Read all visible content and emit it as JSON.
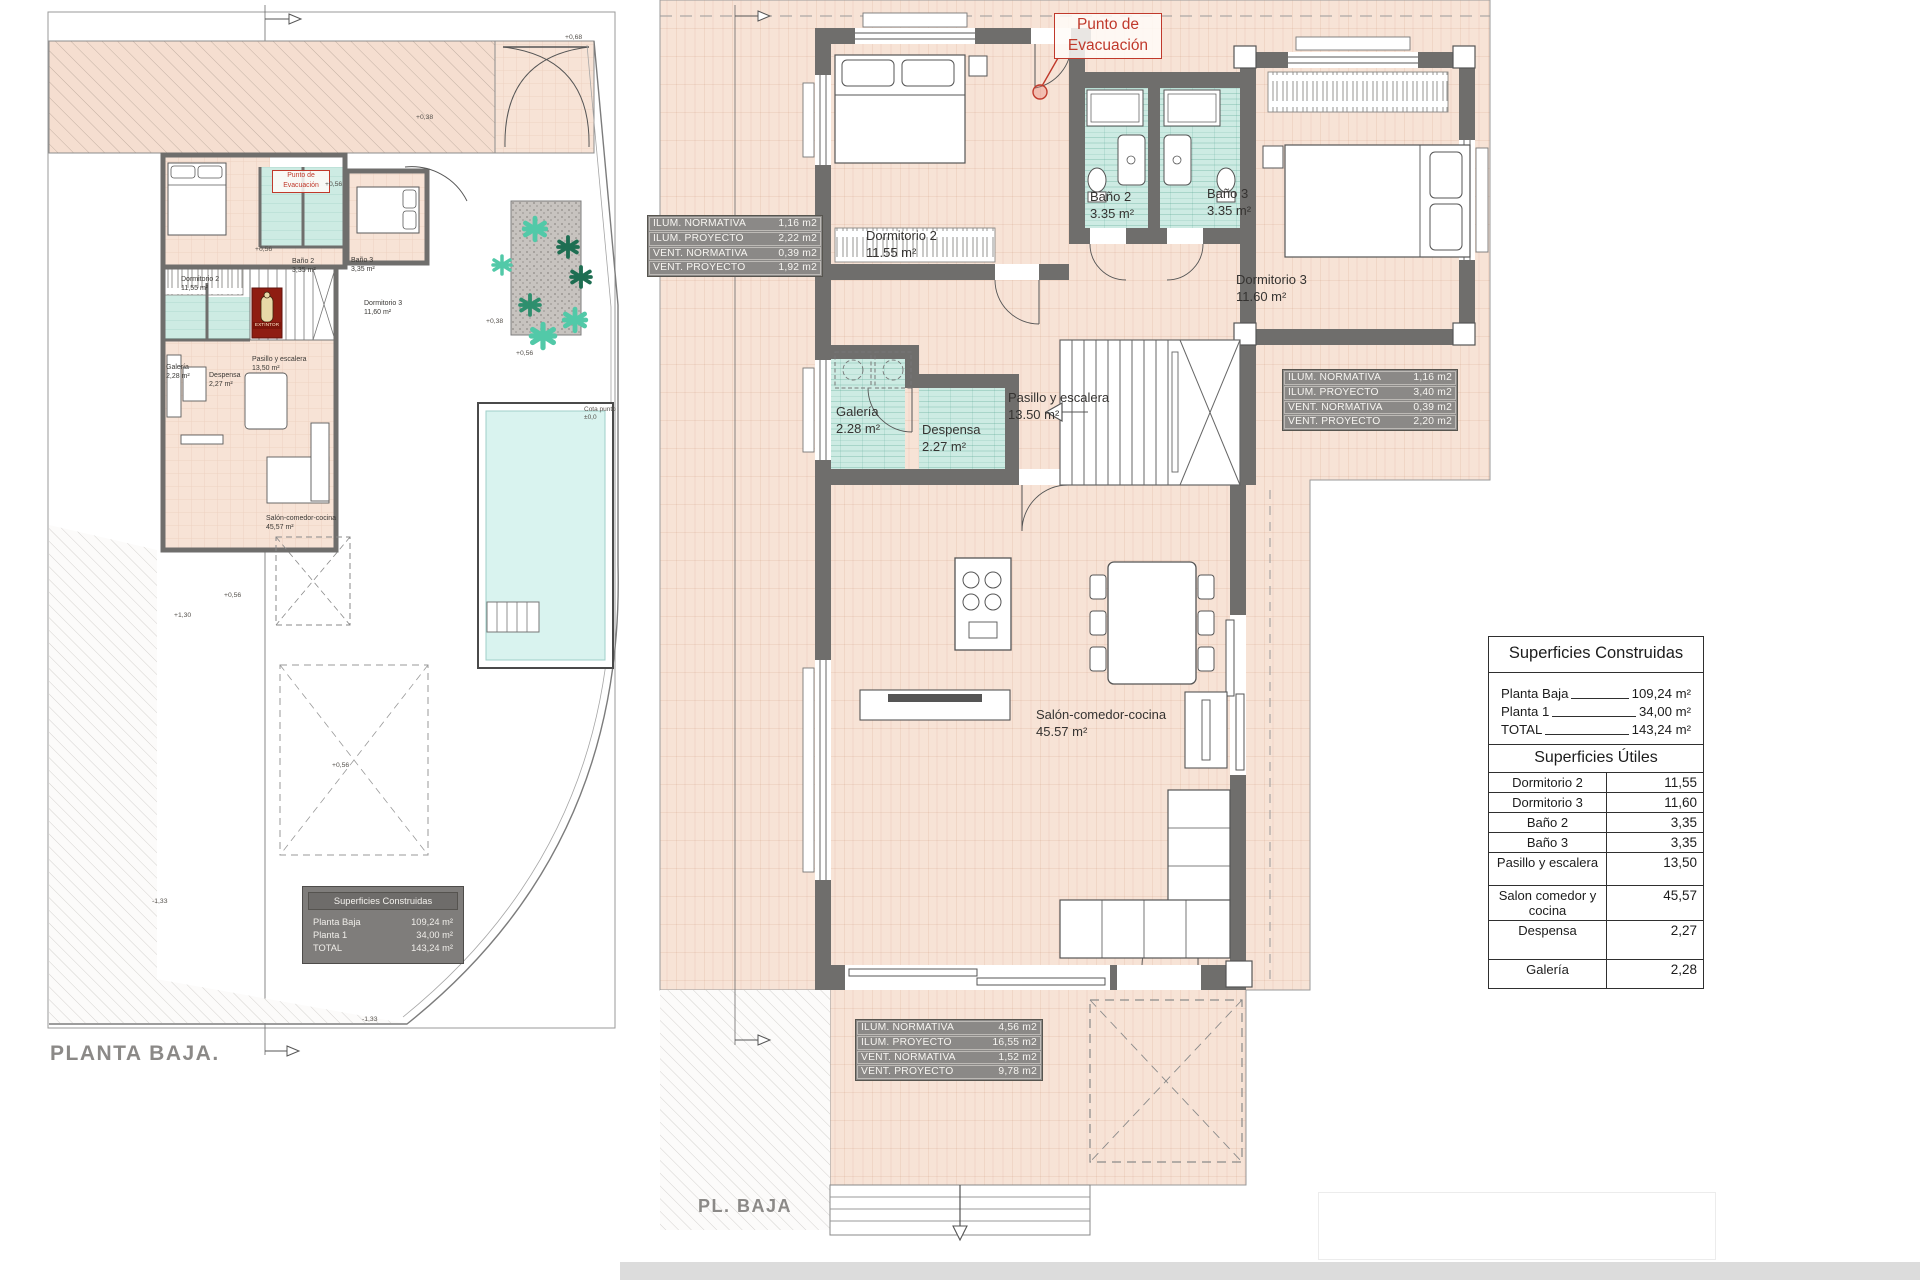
{
  "left_plan": {
    "title": "PLANTA BAJA.",
    "evacuation": {
      "line1": "Punto de",
      "line2": "Evacuación"
    },
    "extintor_label": "EXTINTOR",
    "cota_label": {
      "line1": "Cota punto",
      "line2": "±0,0"
    },
    "rooms": {
      "dormitorio2": {
        "name": "Dormitorio 2",
        "area": "11,55 m²"
      },
      "bano2": {
        "name": "Baño 2",
        "area": "3,35 m²"
      },
      "bano3": {
        "name": "Baño 3",
        "area": "3,35 m²"
      },
      "dormitorio3": {
        "name": "Dormitorio 3",
        "area": "11,60 m²"
      },
      "galeria": {
        "name": "Galería",
        "area": "2,28 m²"
      },
      "despensa": {
        "name": "Despensa",
        "area": "2,27 m²"
      },
      "pasillo": {
        "name": "Pasillo y escalera",
        "area": "13,50 m²"
      },
      "salon": {
        "name": "Salón-comedor-cocina",
        "area": "45,57 m²"
      }
    },
    "elevations": {
      "e068": "+0,68",
      "e038_a": "+0,38",
      "e038_b": "+0,38",
      "e056_a": "+0,56",
      "e056_b": "+0,56",
      "e056_c": "+0,56",
      "e056_d": "+0,56",
      "e056_e": "+0,56",
      "e130": "+1,30",
      "em133_a": "-1,33",
      "em133_b": "-1,33"
    }
  },
  "right_plan": {
    "title": "PL. BAJA",
    "evacuation": {
      "line1": "Punto de",
      "line2": "Evacuación"
    },
    "rooms": {
      "dormitorio2": {
        "name": "Dormitorio 2",
        "area": "11.55 m²"
      },
      "bano2": {
        "name": "Baño 2",
        "area": "3.35 m²"
      },
      "bano3": {
        "name": "Baño 3",
        "area": "3.35 m²"
      },
      "dormitorio3": {
        "name": "Dormitorio 3",
        "area": "11.60 m²"
      },
      "galeria": {
        "name": "Galería",
        "area": "2.28 m²"
      },
      "despensa": {
        "name": "Despensa",
        "area": "2.27 m²"
      },
      "pasillo": {
        "name": "Pasillo y escalera",
        "area": "13.50 m²"
      },
      "salon": {
        "name": "Salón-comedor-cocina",
        "area": "45.57 m²"
      }
    },
    "vent_tables": {
      "dormitorio2": [
        [
          "ILUM. NORMATIVA",
          "1,16 m2"
        ],
        [
          "ILUM. PROYECTO",
          "2,22 m2"
        ],
        [
          "VENT. NORMATIVA",
          "0,39 m2"
        ],
        [
          "VENT. PROYECTO",
          "1,92 m2"
        ]
      ],
      "dormitorio3": [
        [
          "ILUM. NORMATIVA",
          "1,16 m2"
        ],
        [
          "ILUM. PROYECTO",
          "3,40 m2"
        ],
        [
          "VENT. NORMATIVA",
          "0,39 m2"
        ],
        [
          "VENT. PROYECTO",
          "2,20 m2"
        ]
      ],
      "salon": [
        [
          "ILUM. NORMATIVA",
          "4,56 m2"
        ],
        [
          "ILUM. PROYECTO",
          "16,55 m2"
        ],
        [
          "VENT. NORMATIVA",
          "1,52 m2"
        ],
        [
          "VENT. PROYECTO",
          "9,78 m2"
        ]
      ]
    }
  },
  "summary": {
    "construidas": {
      "title": "Superficies Construidas",
      "rows": [
        {
          "label": "Planta Baja",
          "value": "109,24 m²"
        },
        {
          "label": "Planta 1",
          "value": "34,00 m²"
        },
        {
          "label": "TOTAL",
          "value": "143,24 m²"
        }
      ]
    },
    "utiles": {
      "title": "Superficies Útiles",
      "rows": [
        {
          "label": "Dormitorio 2",
          "value": "11,55"
        },
        {
          "label": "Dormitorio 3",
          "value": "11,60"
        },
        {
          "label": "Baño 2",
          "value": "3,35"
        },
        {
          "label": "Baño 3",
          "value": "3,35"
        },
        {
          "label": "Pasillo y escalera",
          "value": "13,50"
        },
        {
          "label": "Salon comedor y cocina",
          "value": "45,57"
        },
        {
          "label": "Despensa",
          "value": "2,27"
        },
        {
          "label": "Galería",
          "value": "2,28"
        }
      ]
    }
  },
  "colors": {
    "accent_red": "#c0392b",
    "wall_gray": "#6f6e6c",
    "floor_peach": "#f7e3d6",
    "wet_room_cyan": "#cdebe3",
    "pool_cyan": "#d9f3ef",
    "info_table_bg": "#8b8987"
  }
}
